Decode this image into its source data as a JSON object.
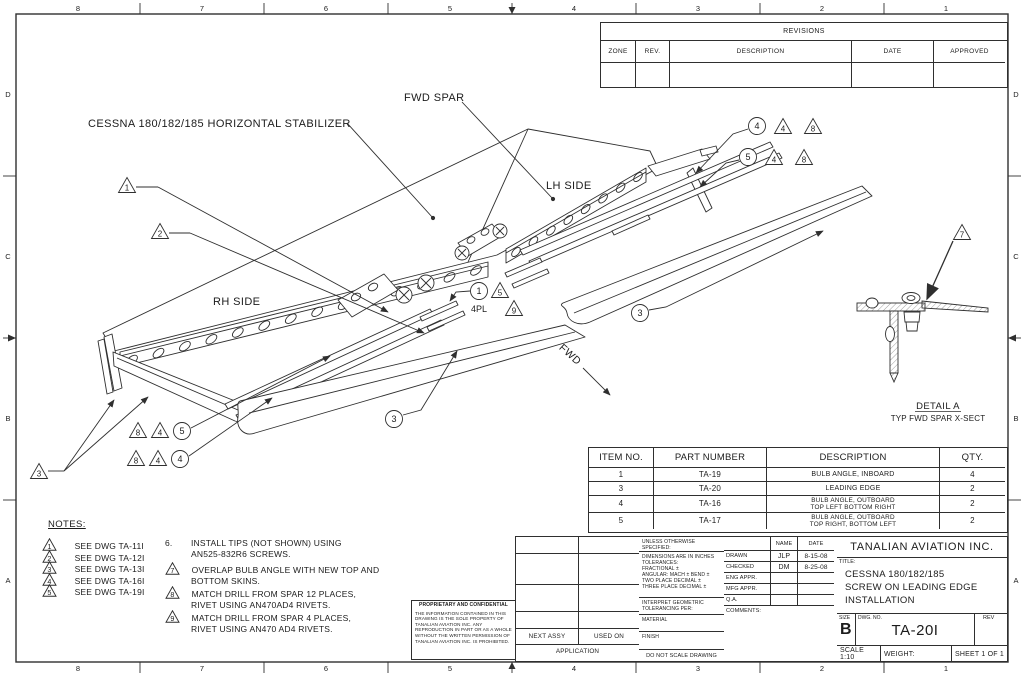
{
  "sheet": {
    "zones_top": [
      "8",
      "7",
      "6",
      "5",
      "4",
      "3",
      "2",
      "1"
    ],
    "zones_bottom": [
      "8",
      "7",
      "6",
      "5",
      "4",
      "3",
      "2",
      "1"
    ],
    "zones_left": [
      "D",
      "C",
      "B",
      "A"
    ],
    "zones_right": [
      "D",
      "C",
      "B",
      "A"
    ]
  },
  "drawing": {
    "label_stabilizer": "CESSNA 180/182/185 HORIZONTAL STABILIZER",
    "label_fwd_spar": "FWD SPAR",
    "label_lh_side": "LH SIDE",
    "label_rh_side": "RH SIDE",
    "label_fwd": "FWD",
    "detail_title": "DETAIL A",
    "detail_subtitle": "TYP FWD SPAR X-SECT",
    "callout_4pl": "4PL",
    "balloons": {
      "b1": "1",
      "b3": "3",
      "b4": "4",
      "b5": "5"
    },
    "flags": {
      "f1": "1",
      "f2": "2",
      "f3": "3",
      "f4": "4",
      "f5": "5",
      "f7": "7",
      "f8": "8",
      "f9": "9"
    }
  },
  "revisions": {
    "title": "REVISIONS",
    "headers": [
      "ZONE",
      "REV.",
      "DESCRIPTION",
      "DATE",
      "APPROVED"
    ]
  },
  "parts": {
    "headers": [
      "ITEM NO.",
      "PART NUMBER",
      "DESCRIPTION",
      "QTY."
    ],
    "rows": [
      {
        "item": "1",
        "part": "TA-19",
        "desc1": "BULB ANGLE, INBOARD",
        "desc2": "",
        "qty": "4"
      },
      {
        "item": "3",
        "part": "TA-20",
        "desc1": "LEADING EDGE",
        "desc2": "",
        "qty": "2"
      },
      {
        "item": "4",
        "part": "TA-16",
        "desc1": "BULB ANGLE, OUTBOARD",
        "desc2": "TOP LEFT BOTTOM RIGHT",
        "qty": "2"
      },
      {
        "item": "5",
        "part": "TA-17",
        "desc1": "BULB ANGLE, OUTBOARD",
        "desc2": "TOP RIGHT, BOTTOM LEFT",
        "qty": "2"
      }
    ]
  },
  "notes": {
    "title": "NOTES:",
    "flag_notes": [
      {
        "num": "1",
        "text": "SEE DWG TA-11I"
      },
      {
        "num": "2",
        "text": "SEE DWG TA-12I"
      },
      {
        "num": "3",
        "text": "SEE DWG TA-13I"
      },
      {
        "num": "4",
        "text": "SEE DWG TA-16I"
      },
      {
        "num": "5",
        "text": "SEE DWG TA-19I"
      }
    ],
    "right_notes": [
      {
        "num": "6.",
        "line1": "INSTALL TIPS (NOT SHOWN) USING",
        "line2": "AN525-832R6 SCREWS."
      },
      {
        "num": "7",
        "line1": "OVERLAP BULB ANGLE WITH NEW TOP AND",
        "line2": "BOTTOM SKINS."
      },
      {
        "num": "8",
        "line1": "MATCH DRILL FROM SPAR 12 PLACES,",
        "line2": "RIVET USING AN470AD4 RIVETS."
      },
      {
        "num": "9",
        "line1": "MATCH DRILL FROM SPAR 4 PLACES,",
        "line2": "RIVET USING AN470 AD4 RIVETS."
      }
    ]
  },
  "proprietary": {
    "title": "PROPRIETARY AND CONFIDENTIAL",
    "body": "THE INFORMATION CONTAINED IN THIS DRAWING IS THE SOLE PROPERTY OF TANALIAN AVIATION INC.  ANY REPRODUCTION IN PART OR AS A WHOLE WITHOUT THE WRITTEN PERMISSION OF TANALIAN AVIATION INC. IS PROHIBITED."
  },
  "title_block": {
    "unless": "UNLESS OTHERWISE SPECIFIED:",
    "tol0": "DIMENSIONS ARE IN INCHES",
    "tol1": "TOLERANCES:",
    "tol2": "FRACTIONAL ±",
    "tol3": "ANGULAR: MACH ±   BEND ±",
    "tol4": "TWO PLACE DECIMAL    ±",
    "tol5": "THREE PLACE DECIMAL  ±",
    "interpret1": "INTERPRET GEOMETRIC",
    "interpret2": "TOLERANCING PER:",
    "material": "MATERIAL",
    "finish": "FINISH",
    "do_not_scale": "DO NOT SCALE DRAWING",
    "col_name": "NAME",
    "col_date": "DATE",
    "rows": [
      {
        "label": "DRAWN",
        "name": "JLP",
        "date": "8-15-08"
      },
      {
        "label": "CHECKED",
        "name": "DM",
        "date": "8-25-08"
      },
      {
        "label": "ENG APPR.",
        "name": "",
        "date": ""
      },
      {
        "label": "MFG APPR.",
        "name": "",
        "date": ""
      },
      {
        "label": "Q.A.",
        "name": "",
        "date": ""
      }
    ],
    "comments": "COMMENTS:",
    "company": "TANALIAN AVIATION INC.",
    "title_label": "TITLE:",
    "title1": "CESSNA 180/182/185",
    "title2": "SCREW ON LEADING EDGE",
    "title3": "INSTALLATION",
    "size_label": "SIZE",
    "size": "B",
    "dwg_label": "DWG.  NO.",
    "dwg_no": "TA-20I",
    "rev_label": "REV",
    "scale": "SCALE 1:10",
    "weight": "WEIGHT:",
    "sheet_no": "SHEET 1 OF 1",
    "next_assy": "NEXT ASSY",
    "used_on": "USED ON",
    "application": "APPLICATION"
  }
}
